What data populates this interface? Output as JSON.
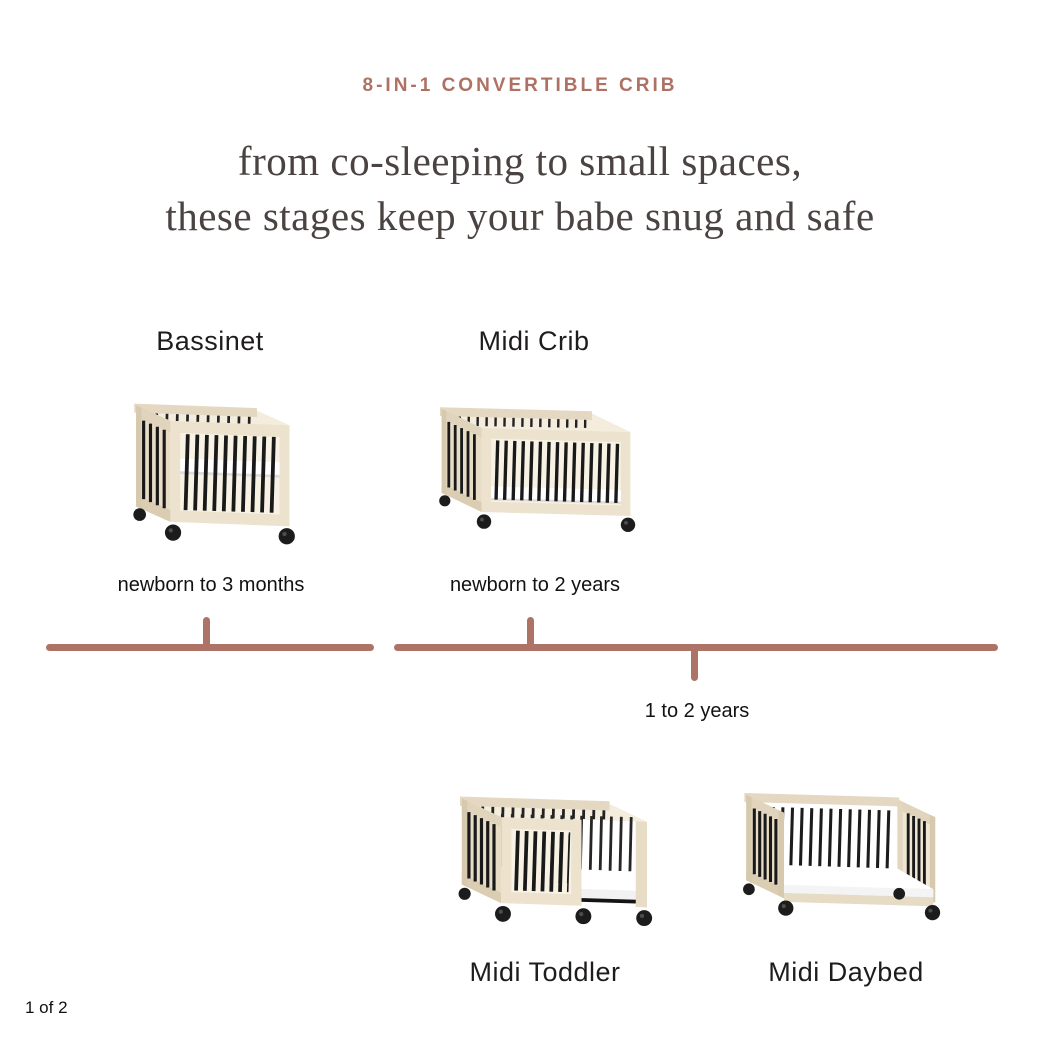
{
  "slide": {
    "eyebrow": "8-IN-1 CONVERTIBLE CRIB",
    "headline_line1": "from co-sleeping to small spaces,",
    "headline_line2": "these stages keep your babe snug and safe",
    "pagination": "1 of 2"
  },
  "stages": [
    {
      "name": "Bassinet",
      "age_range": "newborn to 3 months"
    },
    {
      "name": "Midi Crib",
      "age_range": "newborn to 2 years"
    },
    {
      "name": "Midi Toddler"
    },
    {
      "name": "Midi Daybed"
    }
  ],
  "timeline": {
    "shared_age_label": "1 to 2 years"
  },
  "colors": {
    "accent": "#ae7164",
    "timeline": "#ac7366",
    "headline": "#4a4341",
    "wood": "#ece2cd",
    "slat": "#191919"
  }
}
